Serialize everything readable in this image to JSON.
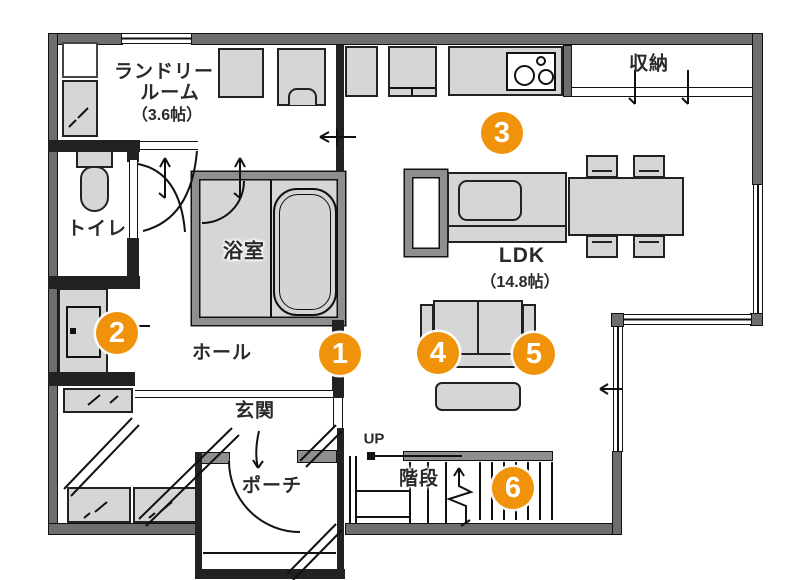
{
  "rooms": {
    "laundry_l1": "ランドリー",
    "laundry_l2": "ルーム",
    "laundry_l3": "（3.6帖）",
    "toilet": "トイレ",
    "bath": "浴室",
    "hall": "ホール",
    "genkan": "玄関",
    "porch": "ポーチ",
    "storage": "収納",
    "ldk": "LDK",
    "ldk_size": "（14.8帖）",
    "stairs": "階段",
    "up": "UP"
  },
  "markers": [
    {
      "label": "1"
    },
    {
      "label": "2"
    },
    {
      "label": "3"
    },
    {
      "label": "4"
    },
    {
      "label": "5"
    },
    {
      "label": "6"
    }
  ],
  "colors": {
    "marker_orange": "#F0930A",
    "wall_gray": "#6E6E6E",
    "furniture_gray": "#D6D6D6",
    "text": "#2A2A2A"
  }
}
